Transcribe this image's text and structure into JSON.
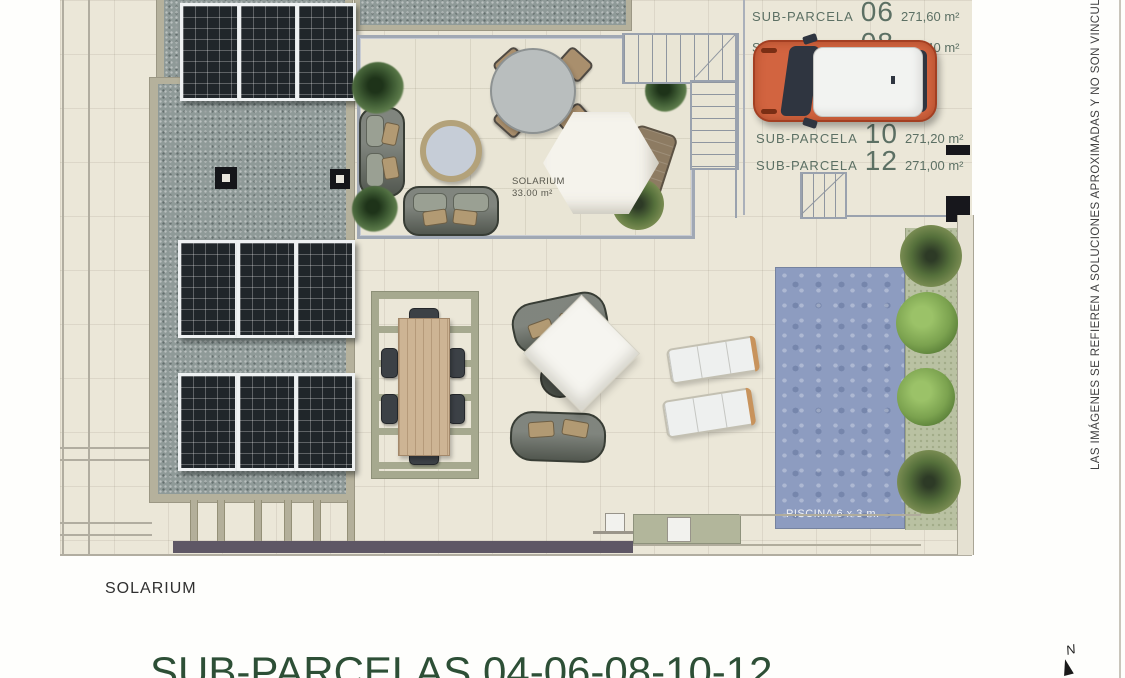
{
  "parcels": [
    {
      "name": "SUB-PARCELA",
      "number": "06",
      "area": "271,60 m²"
    },
    {
      "name": "SUB-PARCELA",
      "number": "08",
      "area": "271,40 m²"
    },
    {
      "name": "SUB-PARCELA",
      "number": "10",
      "area": "271,20 m²"
    },
    {
      "name": "SUB-PARCELA",
      "number": "12",
      "area": "271,00 m²"
    }
  ],
  "solarium": {
    "title": "SOLARIUM",
    "area": "33.00 m²"
  },
  "pool": {
    "label": "PISCINA 6 x 3 m."
  },
  "footer": {
    "solarium": "SOLARIUM",
    "title": "SUB-PARCELAS 04-06-08-10-12"
  },
  "disclaimer": {
    "text": "LAS IMÁGENES SE REFIEREN A SOLUCIONES APROXIMADAS Y NO SON VINCULANTES AL PR"
  },
  "compass": {
    "label": "N"
  },
  "colors": {
    "label_green": "#5c7064",
    "title_green": "#2d4f36",
    "pool_blue": "#8d9cc0",
    "car_orange": "#d26440",
    "gravel_gray": "#8f9a98",
    "terrace_cream": "#e9e5d5"
  }
}
